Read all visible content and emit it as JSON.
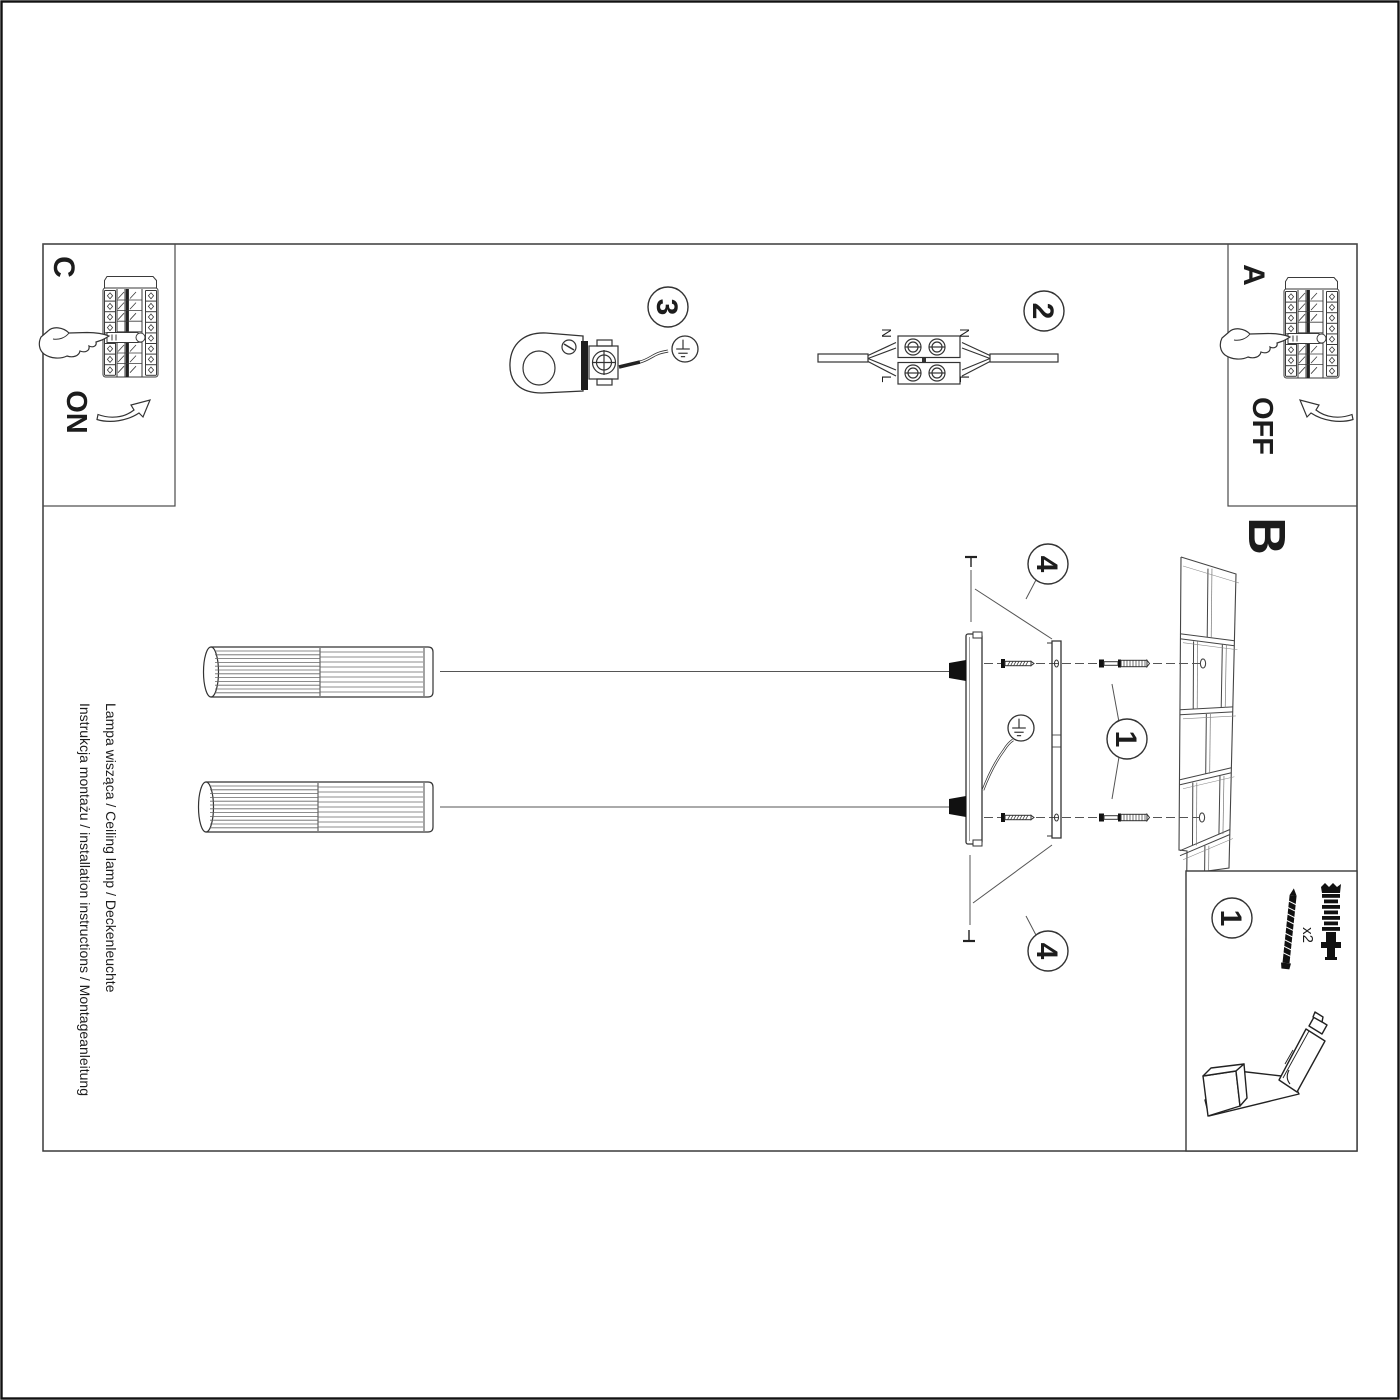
{
  "titles": {
    "line1": "Instrukcja montażu / installation instructions / Montageanleitung",
    "line2": "Lampa wisząca / Ceiling lamp / Deckenleuchte"
  },
  "sections": {
    "a": "A",
    "b": "B",
    "c": "C"
  },
  "switch": {
    "on": "ON",
    "off": "OFF"
  },
  "steps": {
    "s1": "1",
    "s2": "2",
    "s3": "3",
    "s4": "4"
  },
  "wiring": {
    "neutral": "N",
    "live": "L"
  },
  "hardware": {
    "quantity": "x2"
  },
  "colors": {
    "line": "#333333",
    "paper": "#ffffff"
  }
}
